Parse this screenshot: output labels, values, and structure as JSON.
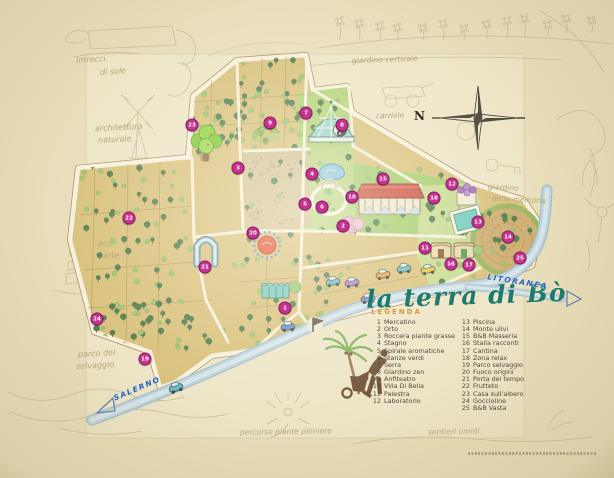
{
  "title": "la terra di Bò",
  "legend": {
    "header": "LEGENDA",
    "col1": [
      {
        "n": "1",
        "label": "Mercatino"
      },
      {
        "n": "2",
        "label": "Orto"
      },
      {
        "n": "3",
        "label": "Roccera piante grasse"
      },
      {
        "n": "4",
        "label": "Stagno"
      },
      {
        "n": "5",
        "label": "Spirale aromatiche"
      },
      {
        "n": "6",
        "label": "Stanze verdi"
      },
      {
        "n": "7",
        "label": "Serra"
      },
      {
        "n": "8",
        "label": "Giardino zen"
      },
      {
        "n": "9",
        "label": "Anfiteatro"
      },
      {
        "n": "10",
        "label": "Villa Di Bella"
      },
      {
        "n": "11",
        "label": "Palestra"
      },
      {
        "n": "12",
        "label": "Laboratorio"
      }
    ],
    "col2": [
      {
        "n": "13",
        "label": "Piscina"
      },
      {
        "n": "14",
        "label": "Monte ulivi"
      },
      {
        "n": "15",
        "label": "B&B Masseria"
      },
      {
        "n": "16",
        "label": "Stalla racconti"
      },
      {
        "n": "17",
        "label": "Cantina"
      },
      {
        "n": "18",
        "label": "Zona relax"
      },
      {
        "n": "19",
        "label": "Parco selvaggio"
      },
      {
        "n": "20",
        "label": "Fuoco origini"
      },
      {
        "n": "21",
        "label": "Porta del tempo"
      },
      {
        "n": "22",
        "label": "Frutteto"
      },
      {
        "n": "23",
        "label": "Casa sull'albero"
      },
      {
        "n": "24",
        "label": "Goccioline"
      },
      {
        "n": "25",
        "label": "B&B Vasta"
      }
    ]
  },
  "roads": {
    "left_label": "SALERNO",
    "right_label": "LITORANEA"
  },
  "compass": {
    "n": "N"
  },
  "markers": [
    {
      "n": "1",
      "x": 285,
      "y": 308
    },
    {
      "n": "2",
      "x": 343,
      "y": 226
    },
    {
      "n": "3",
      "x": 238,
      "y": 168
    },
    {
      "n": "4",
      "x": 312,
      "y": 174
    },
    {
      "n": "5",
      "x": 305,
      "y": 204
    },
    {
      "n": "6",
      "x": 322,
      "y": 207
    },
    {
      "n": "7",
      "x": 306,
      "y": 113
    },
    {
      "n": "8",
      "x": 342,
      "y": 125
    },
    {
      "n": "9",
      "x": 270,
      "y": 123
    },
    {
      "n": "10",
      "x": 352,
      "y": 197
    },
    {
      "n": "11",
      "x": 425,
      "y": 248
    },
    {
      "n": "12",
      "x": 452,
      "y": 184
    },
    {
      "n": "13",
      "x": 478,
      "y": 222
    },
    {
      "n": "14",
      "x": 508,
      "y": 237
    },
    {
      "n": "15",
      "x": 383,
      "y": 179
    },
    {
      "n": "16",
      "x": 451,
      "y": 264
    },
    {
      "n": "17",
      "x": 469,
      "y": 265
    },
    {
      "n": "18",
      "x": 434,
      "y": 198
    },
    {
      "n": "19",
      "x": 145,
      "y": 359
    },
    {
      "n": "20",
      "x": 253,
      "y": 233
    },
    {
      "n": "21",
      "x": 205,
      "y": 267
    },
    {
      "n": "22",
      "x": 129,
      "y": 218
    },
    {
      "n": "23",
      "x": 192,
      "y": 125
    },
    {
      "n": "24",
      "x": 97,
      "y": 319
    },
    {
      "n": "25",
      "x": 520,
      "y": 258
    }
  ],
  "pencil_notes": [
    {
      "text": "intrecci",
      "x": 76,
      "y": 55,
      "r": -4,
      "s": 8
    },
    {
      "text": "di sole",
      "x": 100,
      "y": 67,
      "r": -4,
      "s": 8
    },
    {
      "text": "architettura",
      "x": 95,
      "y": 123,
      "r": -3,
      "s": 8
    },
    {
      "text": "naturale",
      "x": 98,
      "y": 135,
      "r": -3,
      "s": 8
    },
    {
      "text": "eco",
      "x": 98,
      "y": 239,
      "r": -2,
      "s": 8
    },
    {
      "text": "arte",
      "x": 103,
      "y": 251,
      "r": -2,
      "s": 8
    },
    {
      "text": "parco del",
      "x": 78,
      "y": 349,
      "r": -3,
      "s": 8
    },
    {
      "text": "selvaggio",
      "x": 76,
      "y": 361,
      "r": -3,
      "s": 8
    },
    {
      "text": "giardino verticale",
      "x": 352,
      "y": 55,
      "r": -2,
      "s": 7.5
    },
    {
      "text": "carriole",
      "x": 376,
      "y": 111,
      "r": -2,
      "s": 7.5
    },
    {
      "text": "giardino",
      "x": 488,
      "y": 183,
      "r": 3,
      "s": 7.5
    },
    {
      "text": "della memoria",
      "x": 492,
      "y": 195,
      "r": 3,
      "s": 7.5
    },
    {
      "text": "percorso piante pioniere",
      "x": 240,
      "y": 427,
      "r": -1,
      "s": 7.5
    },
    {
      "text": "sentieri umidi",
      "x": 428,
      "y": 427,
      "r": -1,
      "s": 7.5
    }
  ],
  "colors": {
    "paper": "#e9debb",
    "field_tan": "#d6bc72",
    "field_green": "#a9cf6d",
    "river": "#b5d0e2",
    "marker": "#c63390",
    "title": "#1f7a6d",
    "road_text": "#2f63a8"
  }
}
